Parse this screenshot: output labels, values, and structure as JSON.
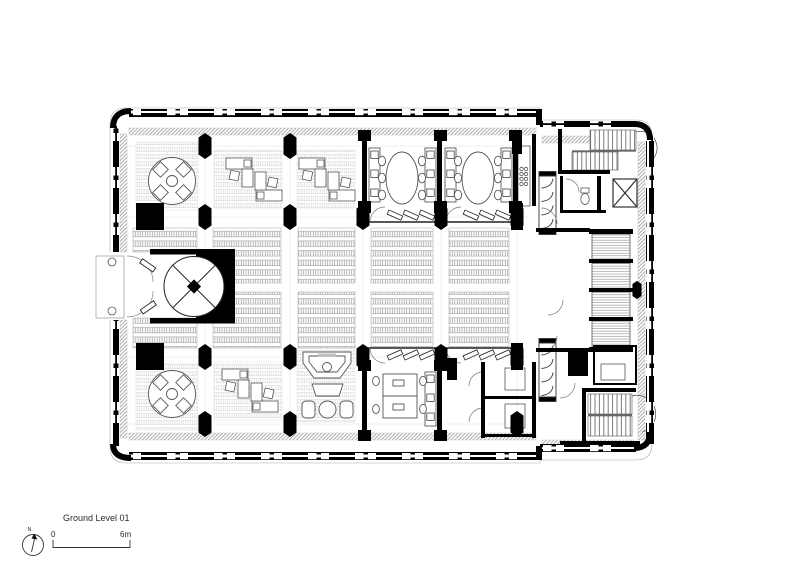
{
  "page": {
    "background": "#ffffff"
  },
  "drawing": {
    "type": "architectural-floor-plan",
    "level_label": "Ground Level 01",
    "north": {
      "label": "N",
      "symbol": "north-arrow-icon"
    },
    "scale_bar": {
      "start_label": "0",
      "end_label": "6m"
    },
    "colors": {
      "walls": "#000000",
      "hatch_band": "#999999",
      "furniture_line": "#555555",
      "panel_line": "#9a9a9a",
      "background": "#ffffff"
    },
    "symbols": [
      "north-arrow-icon",
      "revolving-door",
      "entrance-canopy",
      "stairs",
      "elevator",
      "wc-toilet",
      "round-meeting-table",
      "oval-meeting-table",
      "desk-cluster",
      "reception-desk",
      "lounge-seating",
      "storage-cabinet",
      "structural-column",
      "window-mullion",
      "floor-stack-panel"
    ]
  }
}
